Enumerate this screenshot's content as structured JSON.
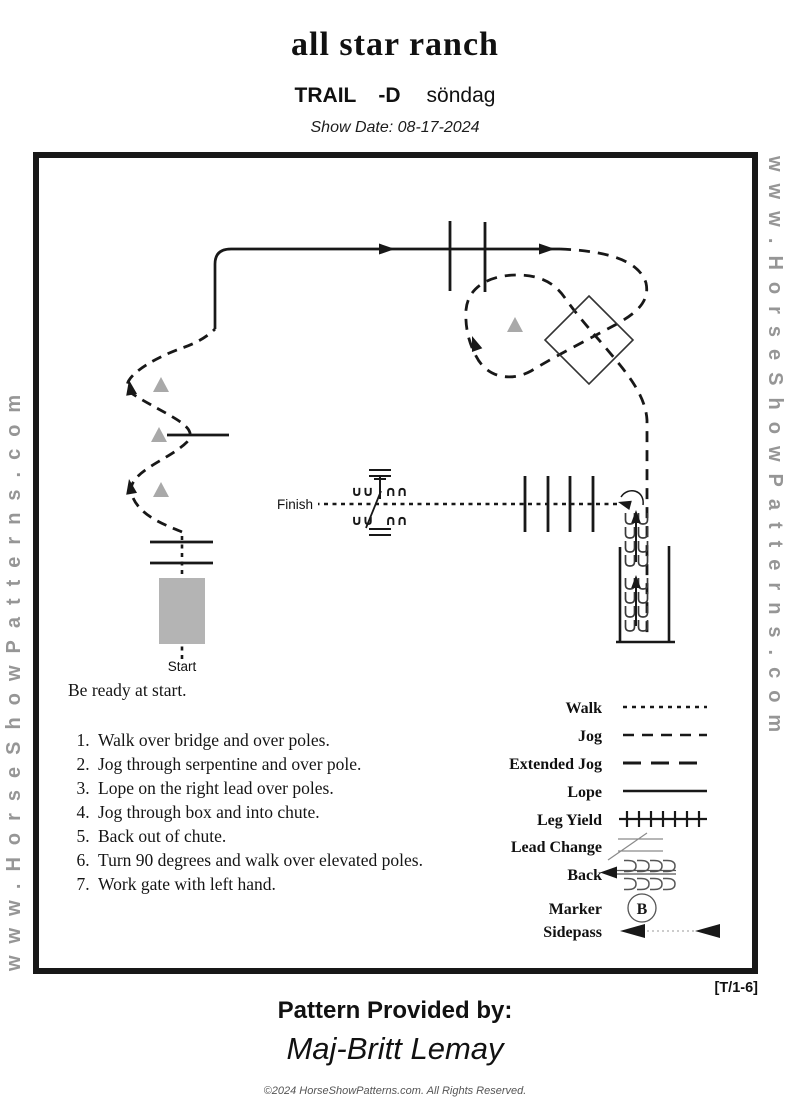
{
  "header": {
    "title": "all star ranch",
    "class_label": "TRAIL",
    "class_suffix": "-D",
    "day": "söndag",
    "show_date": "Show Date: 08-17-2024"
  },
  "watermark": {
    "left": "www.HorseShowPatterns.com",
    "right": "www.HorseShowPatterns.com"
  },
  "diagram": {
    "start_label": "Start",
    "finish_label": "Finish",
    "gate_glyph_u": "∪∪",
    "gate_glyph_n": "∩∩"
  },
  "instructions": {
    "intro": "Be ready at start.",
    "items": [
      "Walk over bridge and over poles.",
      "Jog through serpentine and over pole.",
      "Lope on the right lead over poles.",
      "Jog through box and into chute.",
      "Back out of  chute.",
      "Turn 90 degrees and walk over elevated poles.",
      "Work gate with left hand."
    ]
  },
  "legend": {
    "items": [
      {
        "label": "Walk"
      },
      {
        "label": "Jog"
      },
      {
        "label": "Extended Jog"
      },
      {
        "label": "Lope"
      },
      {
        "label": "Leg Yield"
      },
      {
        "label": "Lead Change"
      },
      {
        "label": "Back"
      },
      {
        "label": "Marker",
        "letter": "B"
      },
      {
        "label": "Sidepass"
      }
    ]
  },
  "footer": {
    "page_ref": "[T/1-6]",
    "provided_by_label": "Pattern Provided by:",
    "provided_by_name": "Maj-Britt Lemay",
    "copyright": "©2024 HorseShowPatterns.com. All Rights Reserved."
  },
  "colors": {
    "ink": "#181818",
    "gray_obstacle": "#aaaaaa",
    "watermark_gray": "#969696"
  }
}
